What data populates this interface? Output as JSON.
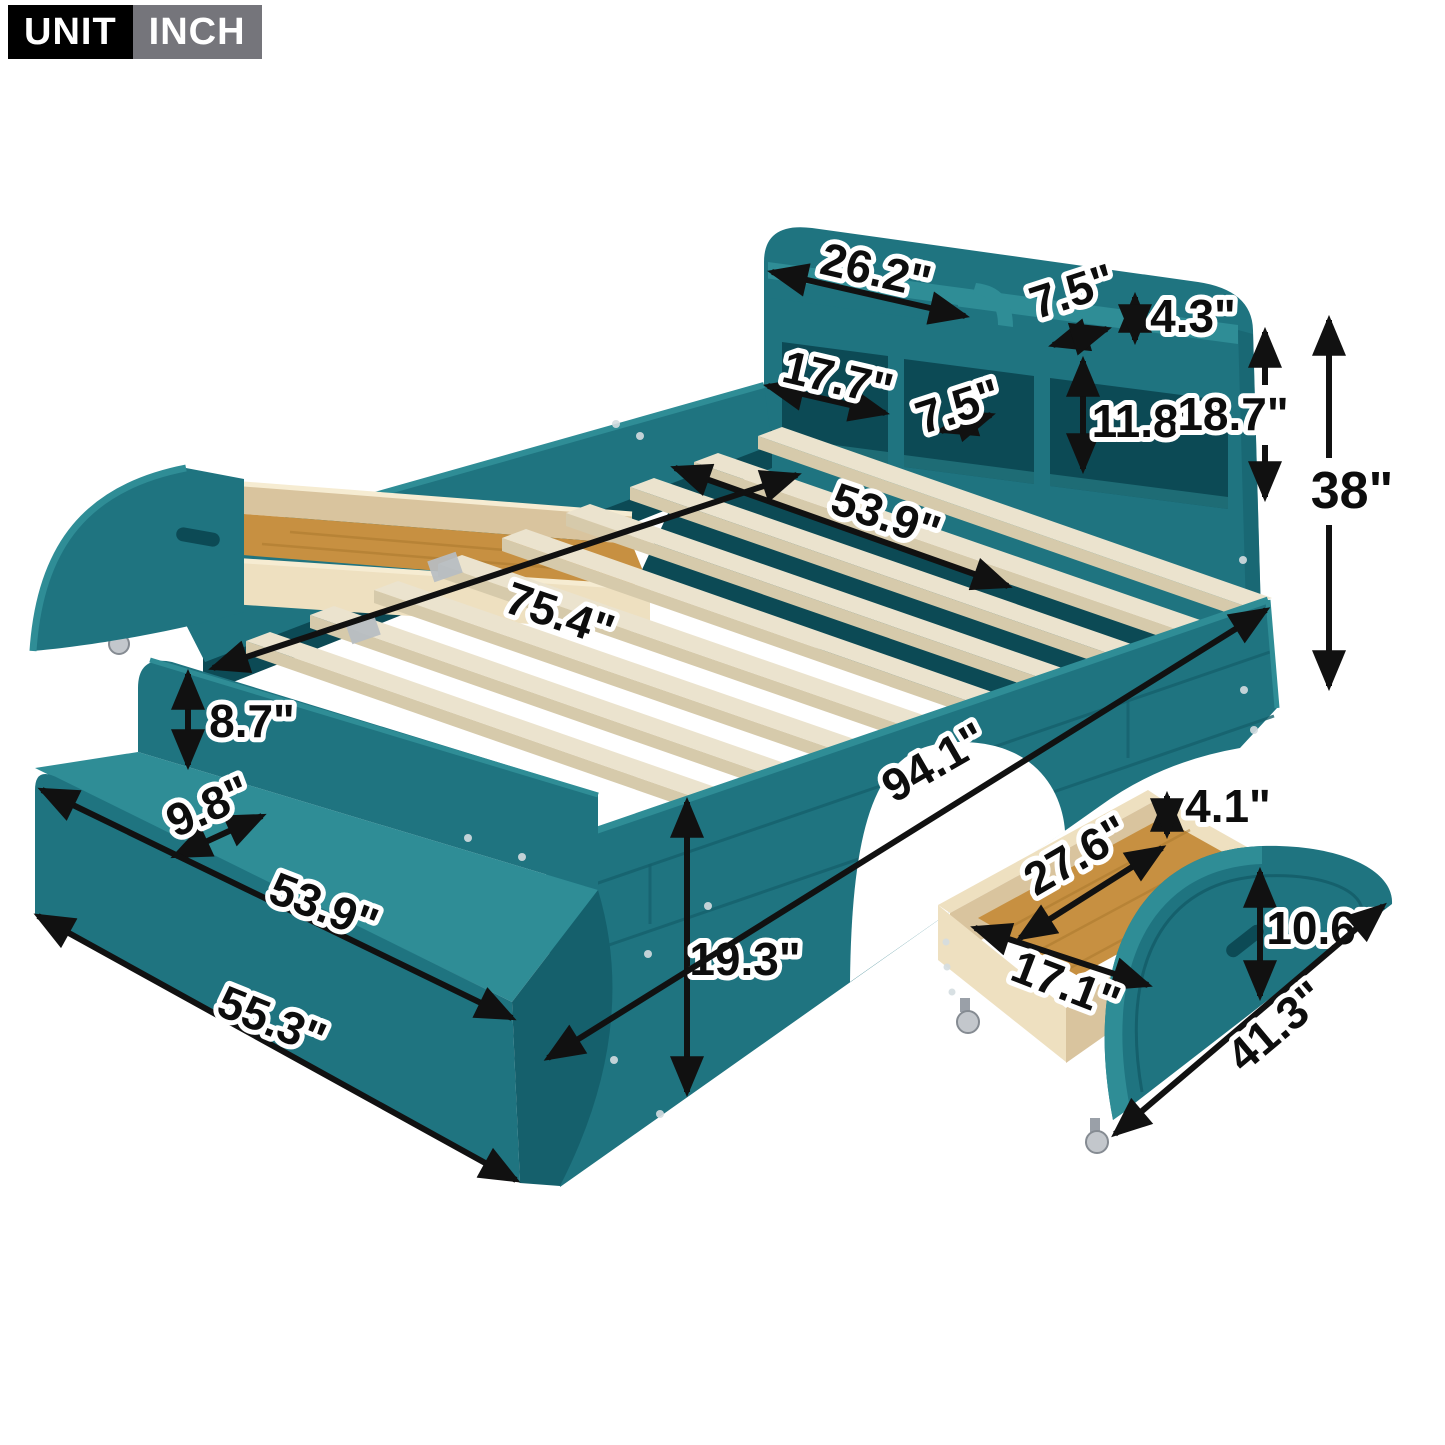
{
  "unit_badge": {
    "unit": "UNIT",
    "value": "INCH"
  },
  "colors": {
    "teal_mid": "#1f7480",
    "teal_light": "#2f8d96",
    "teal_deep": "#15606c",
    "teal_dark": "#0c4a55",
    "slat_top": "#ebe3ce",
    "slat_side": "#d6caab",
    "oak": "#c79041",
    "oak_line": "#a8762c",
    "ply_light": "#eee0c0",
    "ply_shadow": "#d9c49e",
    "ply_edge": "#f6ecd2",
    "caster": "#c3c7cc",
    "caster_dark": "#858b92",
    "arrow": "#111111",
    "screw": "#d4dde0",
    "badge_black": "#000000",
    "badge_grey": "#75757b",
    "white": "#ffffff"
  },
  "dimensions": {
    "headboard_top_shelf_width": "26.2\"",
    "headboard_top_shelf_depth": "7.5\"",
    "headboard_top_shelf_height": "4.3\"",
    "headboard_cubby_width": "17.7\"",
    "headboard_cubby_depth": "7.5\"",
    "headboard_cubby_height": "11.8\"",
    "headboard_upper_height": "18.7\"",
    "headboard_total_height": "38\"",
    "slat_span_width": "53.9\"",
    "slat_area_length": "75.4\"",
    "footboard_back_height": "8.7\"",
    "footboard_shelf_depth": "9.8\"",
    "footboard_shelf_width": "53.9\"",
    "footboard_outer_width": "55.3\"",
    "side_rail_height": "19.3\"",
    "overall_length": "94.1\"",
    "drawer_wall_height": "4.1\"",
    "drawer_inner_width": "27.6\"",
    "drawer_inner_depth": "17.1\"",
    "drawer_panel_height": "10.6\"",
    "drawer_panel_length": "41.3\""
  }
}
